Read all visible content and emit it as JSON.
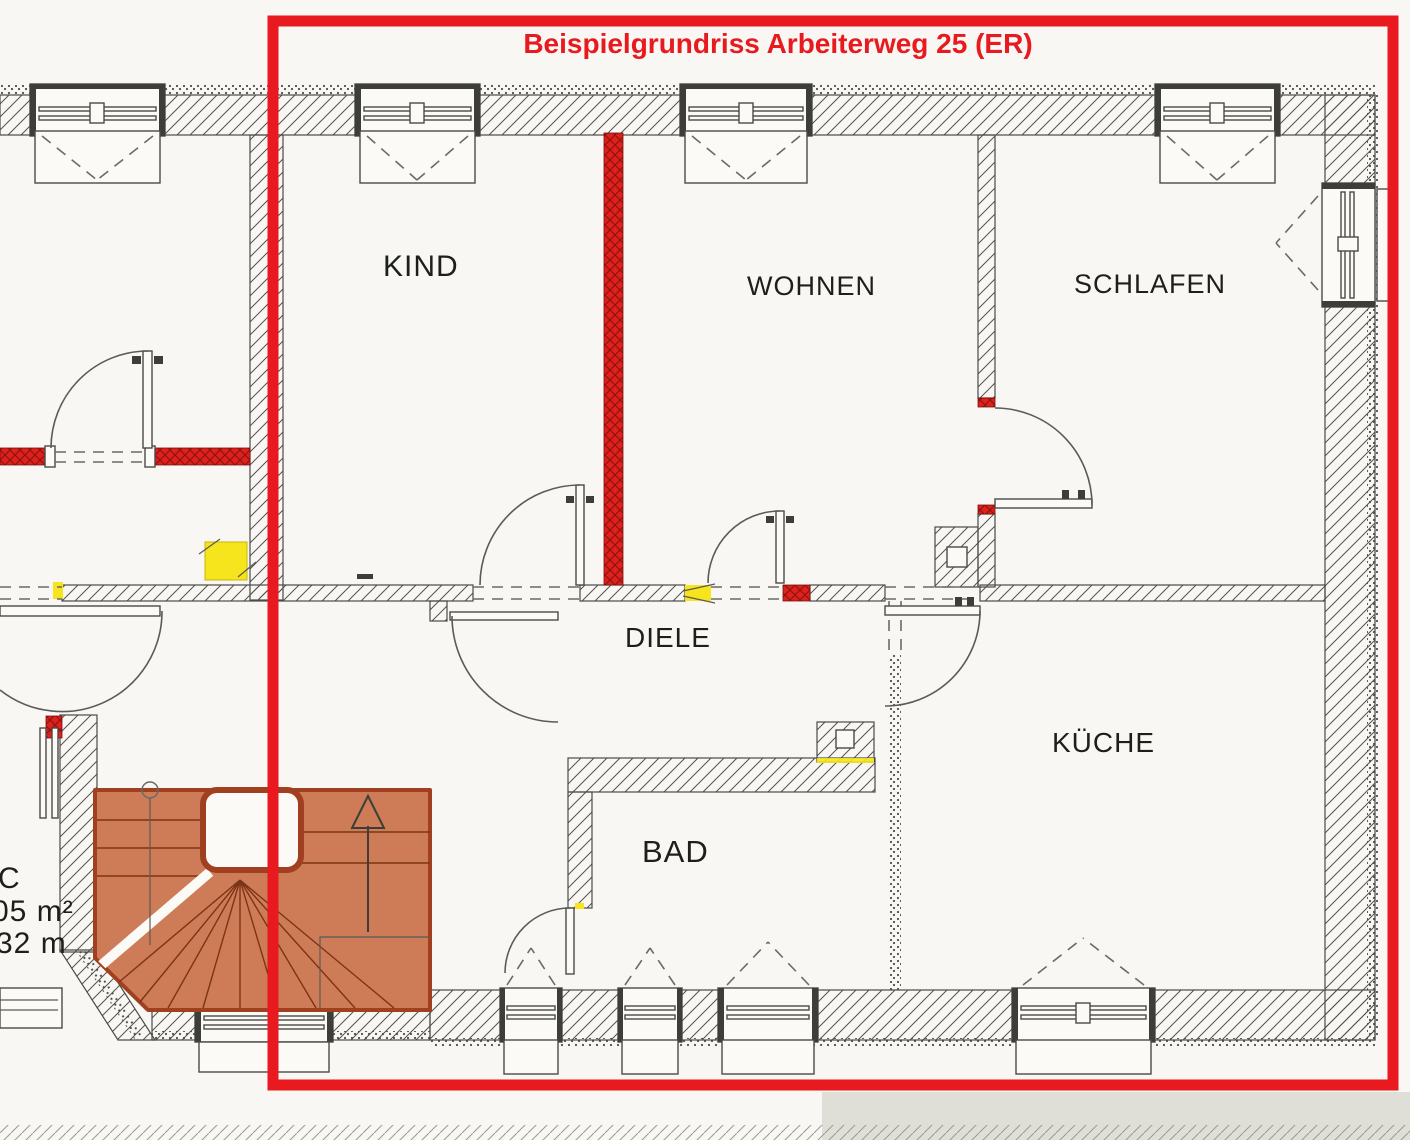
{
  "title": "Beispielgrundriss Arbeiterweg 25 (ER)",
  "rooms": {
    "kind": "KIND",
    "wohnen": "WOHNEN",
    "schlafen": "SCHLAFEN",
    "diele": "DIELE",
    "bad": "BAD",
    "kueche": "KÜCHE"
  },
  "side_annotations": {
    "line1": "C",
    "line2": "05 m²",
    "line3": "32 m"
  },
  "stairs": {
    "direction_arrow": "up"
  },
  "colors": {
    "border_red": "#e8191f",
    "wall_red": "#e0201d",
    "highlight_yellow": "#f6e41c",
    "stairs_orange": "#cd7c57",
    "line": "#4a4a46"
  }
}
